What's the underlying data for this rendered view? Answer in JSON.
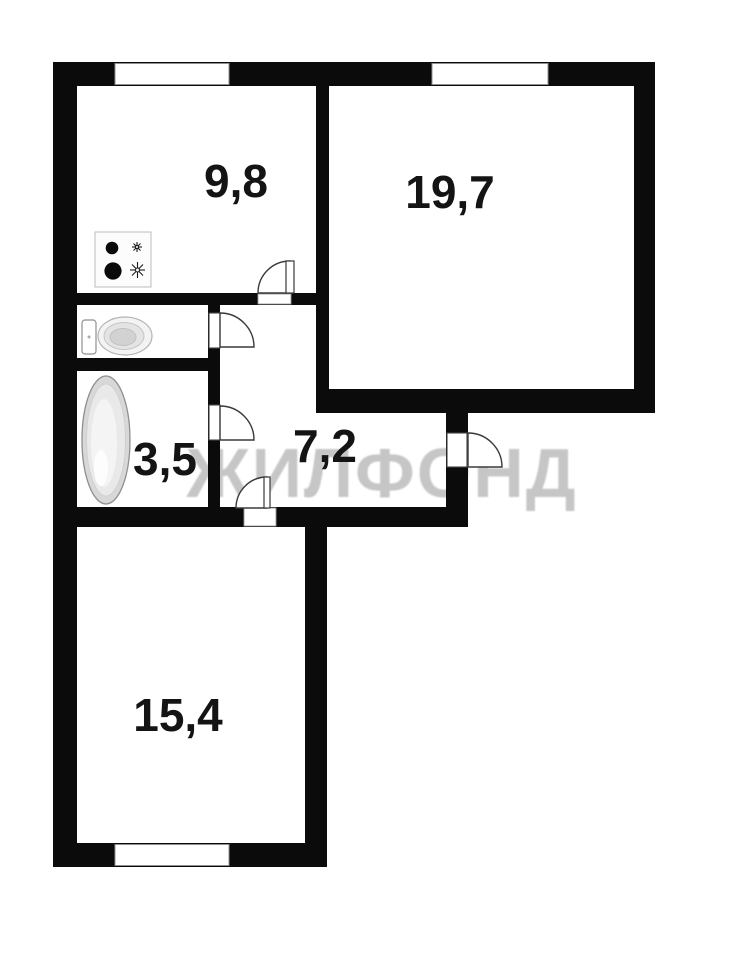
{
  "plan": {
    "watermark_text": "ЖИЛФОНД",
    "rooms": [
      {
        "name": "kitchen",
        "area_label": "9,8"
      },
      {
        "name": "living-room",
        "area_label": "19,7"
      },
      {
        "name": "bathroom",
        "area_label": "3,5"
      },
      {
        "name": "hallway",
        "area_label": "7,2"
      },
      {
        "name": "bedroom",
        "area_label": "15,4"
      }
    ],
    "fixtures": [
      "stove-icon",
      "toilet-icon",
      "bathtub-icon"
    ],
    "windows_count": 3,
    "doors_count": 5,
    "colors": {
      "wall": "#0b0b0b",
      "background": "#ffffff",
      "watermark": "#c6c6c6",
      "label": "#141414",
      "fixture_outline": "#9a9a9a"
    }
  }
}
